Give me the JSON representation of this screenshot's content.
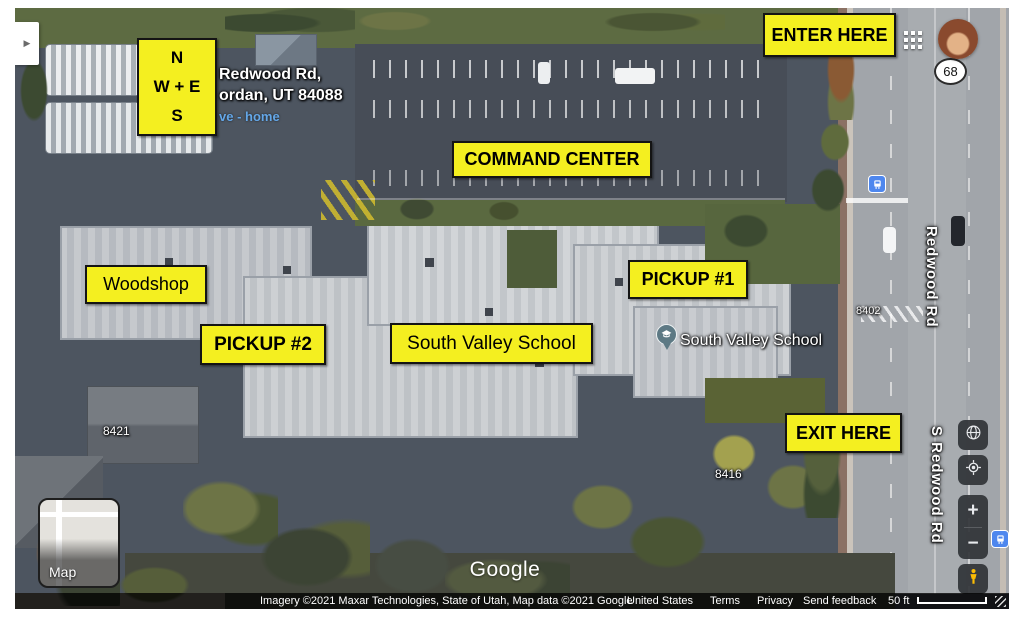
{
  "compass": {
    "north": "N",
    "middle": "W + E",
    "south": "S"
  },
  "annotations": [
    {
      "id": "enter-here",
      "text": "ENTER HERE"
    },
    {
      "id": "command-center",
      "text": "COMMAND CENTER"
    },
    {
      "id": "pickup-1",
      "text": "PICKUP #1"
    },
    {
      "id": "woodshop",
      "text": "Woodshop"
    },
    {
      "id": "pickup-2",
      "text": "PICKUP #2"
    },
    {
      "id": "south-valley-school",
      "text": "South Valley School"
    },
    {
      "id": "exit-here",
      "text": "EXIT HERE"
    }
  ],
  "address_overlay": {
    "line1": "Redwood Rd,",
    "line2": "ordan, UT 84088",
    "link_text": "ve - home"
  },
  "place_marker": {
    "label": "South Valley School"
  },
  "route_badge": {
    "number": "68"
  },
  "street_labels": {
    "north": "Redwood Rd",
    "south": "S Redwood Rd"
  },
  "house_numbers": {
    "a": "8402",
    "b": "8421",
    "c": "8416"
  },
  "map_controls": {
    "zoom_in": "+",
    "zoom_out": "−",
    "sidebar_expand": "▶"
  },
  "icons": {
    "apps_grid": "grid-3x3",
    "globe": "globe",
    "my_location": "crosshair",
    "pegman": "person",
    "bus": "bus-stop",
    "school_pin": "graduation-cap"
  },
  "map_type_toggle": {
    "label": "Map"
  },
  "watermark": "Google",
  "attribution": {
    "imagery": "Imagery ©2021 Maxar Technologies, State of Utah, Map data ©2021 Google",
    "country": "United States",
    "terms": "Terms",
    "privacy": "Privacy",
    "send_feedback": "Send feedback",
    "scale_label": "50 ft"
  },
  "colors": {
    "annotation_yellow": "#f4ef20",
    "annotation_border": "#141414",
    "bus_blue": "#4e87ee",
    "control_bg": "#303337",
    "pegman_yellow": "#fbbc04",
    "link_blue": "#64a7e8"
  }
}
